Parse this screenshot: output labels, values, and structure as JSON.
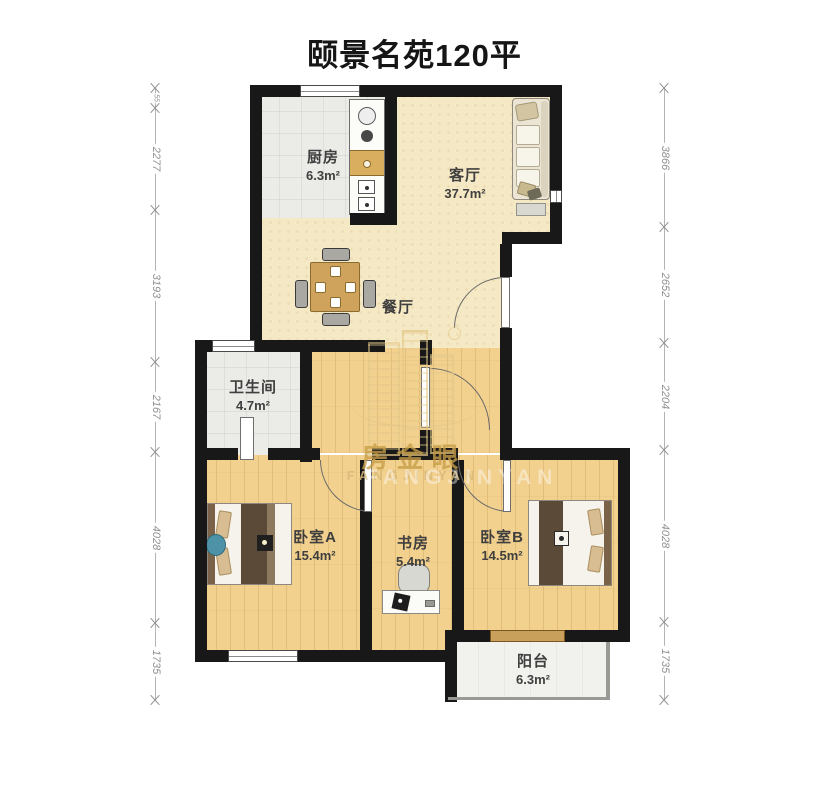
{
  "title": "颐景名苑120平",
  "rooms": {
    "kitchen": {
      "name": "厨房",
      "area": "6.3m²"
    },
    "living": {
      "name": "客厅",
      "area": "37.7m²"
    },
    "dining": {
      "name": "餐厅",
      "area": ""
    },
    "bathroom": {
      "name": "卫生间",
      "area": "4.7m²"
    },
    "bedroom_a": {
      "name": "卧室A",
      "area": "15.4m²"
    },
    "study": {
      "name": "书房",
      "area": "5.4m²"
    },
    "bedroom_b": {
      "name": "卧室B",
      "area": "14.5m²"
    },
    "balcony": {
      "name": "阳台",
      "area": "6.3m²"
    }
  },
  "dimensions": {
    "left": [
      "55",
      "2277",
      "3193",
      "2167",
      "4028",
      "1735"
    ],
    "right": [
      "3866",
      "2652",
      "2204",
      "4028",
      "1735"
    ]
  },
  "watermark": {
    "cn": "房金眼",
    "en": "FANGJINYAN"
  },
  "colors": {
    "wall": "#181818",
    "wood_floor": "#f2d18f",
    "beige_floor": "#f5e8c4",
    "tile_floor": "#ebece8",
    "watermark_gold": "#c9a145"
  }
}
